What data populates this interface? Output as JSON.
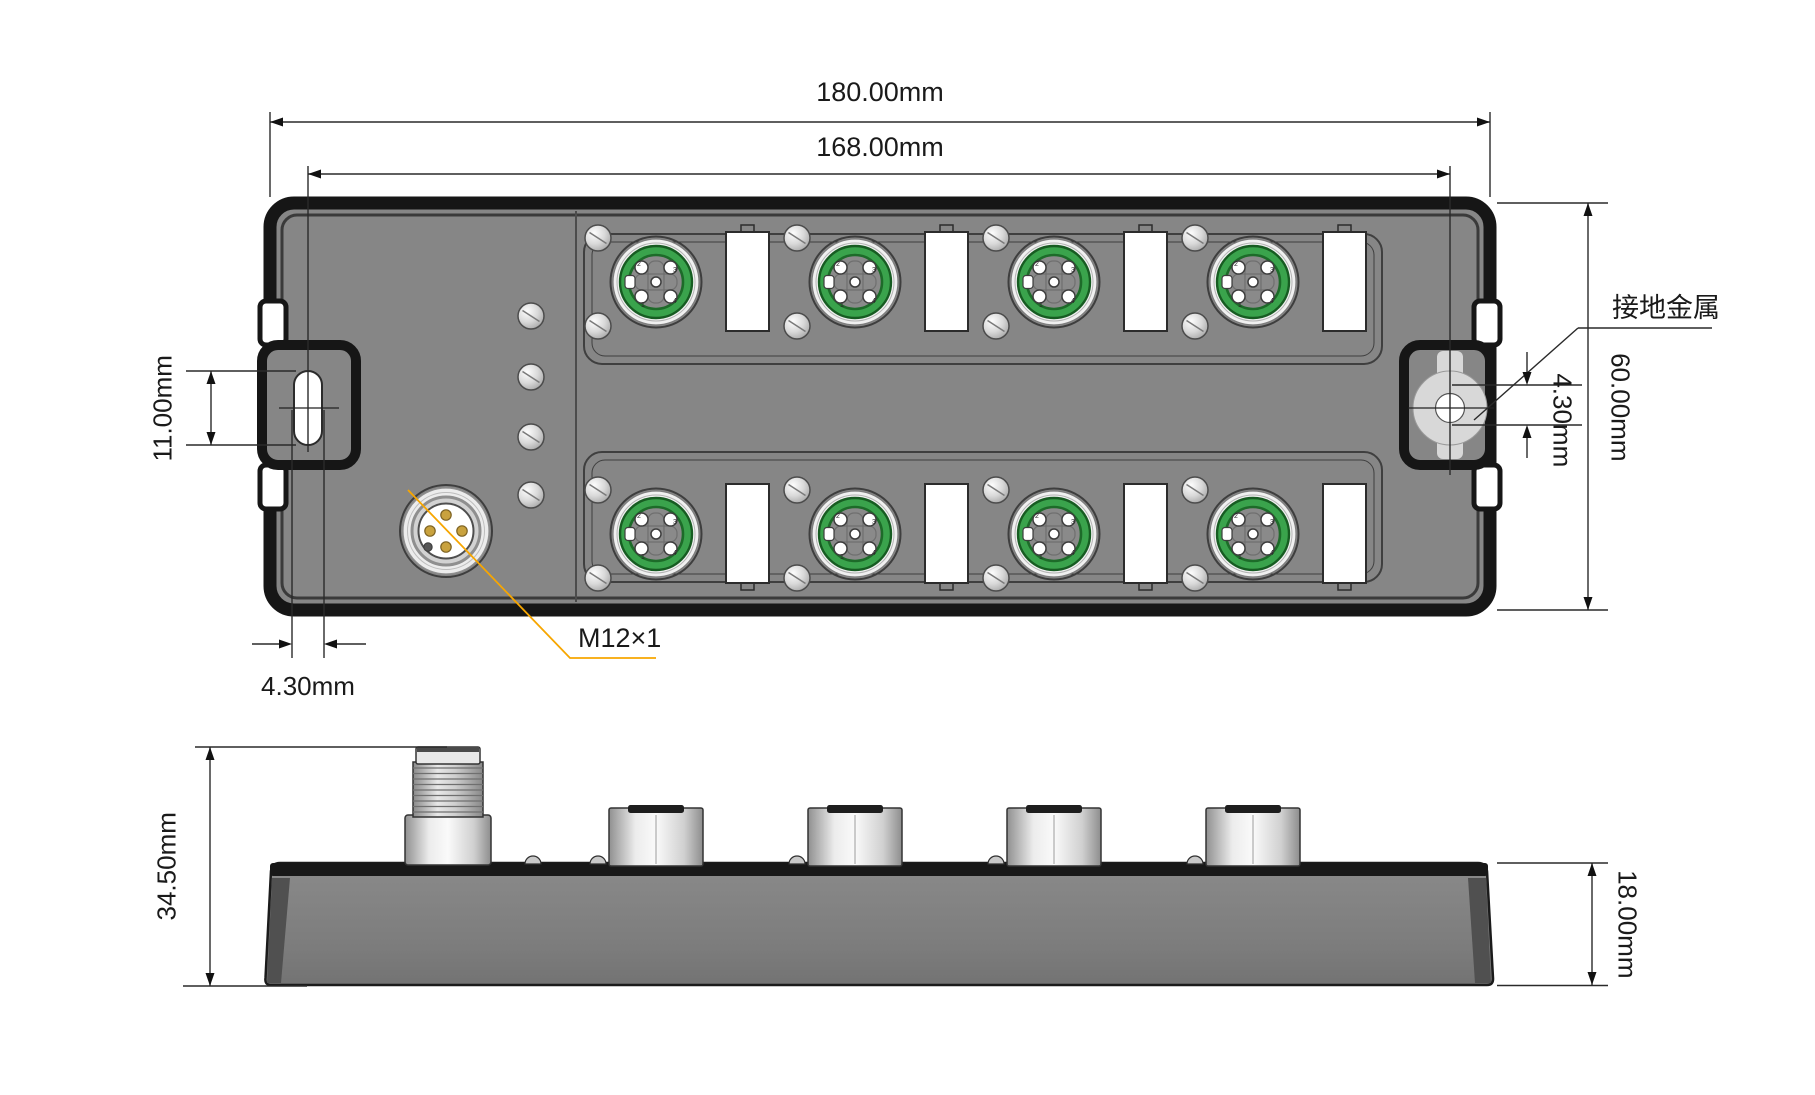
{
  "drawing": {
    "dims": {
      "overall_width": "180.00mm",
      "hole_span": "168.00mm",
      "slot_length": "11.00mm",
      "slot_width": "4.30mm",
      "overall_depth": "60.00mm",
      "ground_hole": "4.30mm",
      "total_height": "34.50mm",
      "body_height": "18.00mm"
    },
    "labels": {
      "ground_metal": "接地金属",
      "thread_size": "M12×1"
    },
    "pins": {
      "p1": "1",
      "p2": "2",
      "p3": "3",
      "p4": "4"
    },
    "colors": {
      "body_gray": "#868686",
      "outline_black": "#161616",
      "connector_green": "#3aa34c",
      "pin_gold": "#c9a23e",
      "leader_orange": "#f7a600"
    }
  }
}
